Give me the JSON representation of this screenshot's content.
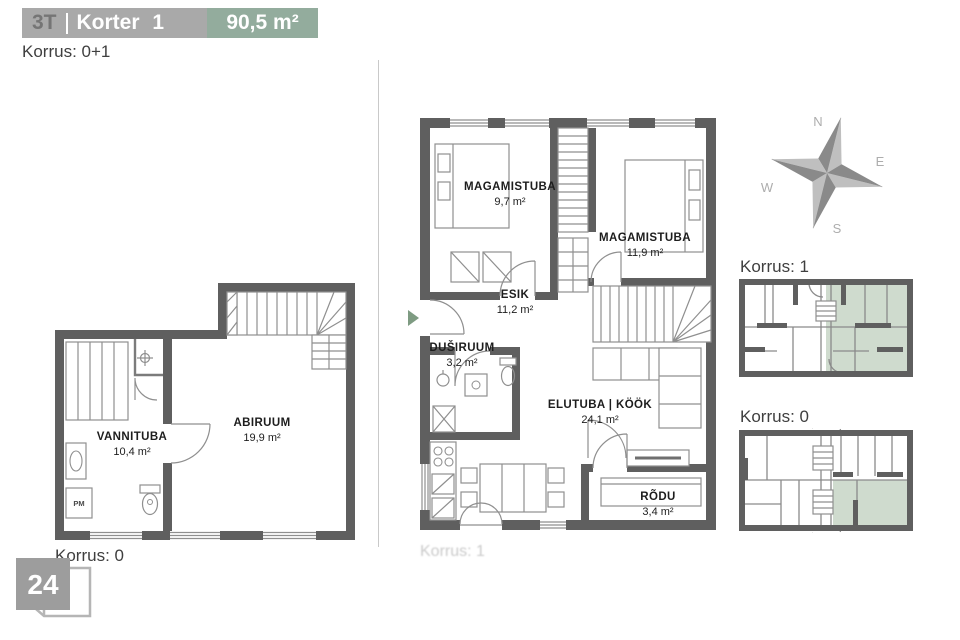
{
  "header": {
    "unit_type": "3T",
    "unit_name": "Korter 1",
    "area": "90,5 m²"
  },
  "floors_note": "Korrus: 0+1",
  "page_number": "24",
  "compass": {
    "north": "N",
    "east": "E",
    "south": "S",
    "west": "W"
  },
  "plan_lower": {
    "caption": "Korrus: 0",
    "appliance_label": "PM",
    "rooms": {
      "vannituba": {
        "name": "VANNITUBA",
        "area": "10,4 m²"
      },
      "abiruum": {
        "name": "ABIRUUM",
        "area": "19,9 m²"
      }
    }
  },
  "plan_upper": {
    "caption_faint": "Korrus: 1",
    "rooms": {
      "magamistuba1": {
        "name": "MAGAMISTUBA",
        "area": "9,7 m²"
      },
      "magamistuba2": {
        "name": "MAGAMISTUBA",
        "area": "11,9 m²"
      },
      "esik": {
        "name": "ESIK",
        "area": "11,2 m²"
      },
      "dusiruum": {
        "name": "DUŠIRUUM",
        "area": "3,2 m²"
      },
      "elutuba_kook": {
        "name": "ELUTUBA | KÖÖK",
        "area": "24,1 m²"
      },
      "rodu": {
        "name": "RÕDU",
        "area": "3,4 m²"
      }
    }
  },
  "key_plans": {
    "first": {
      "title": "Korrus: 1"
    },
    "second": {
      "title": "Korrus: 0"
    }
  },
  "colors": {
    "header_gray": "#a9a9a9",
    "header_green": "#93ac9d",
    "wall_gray": "#5f5f5f",
    "highlight_green": "#cfdbce",
    "badge_gray": "#9d9d9d",
    "entry_arrow_green": "#7e9b82"
  }
}
